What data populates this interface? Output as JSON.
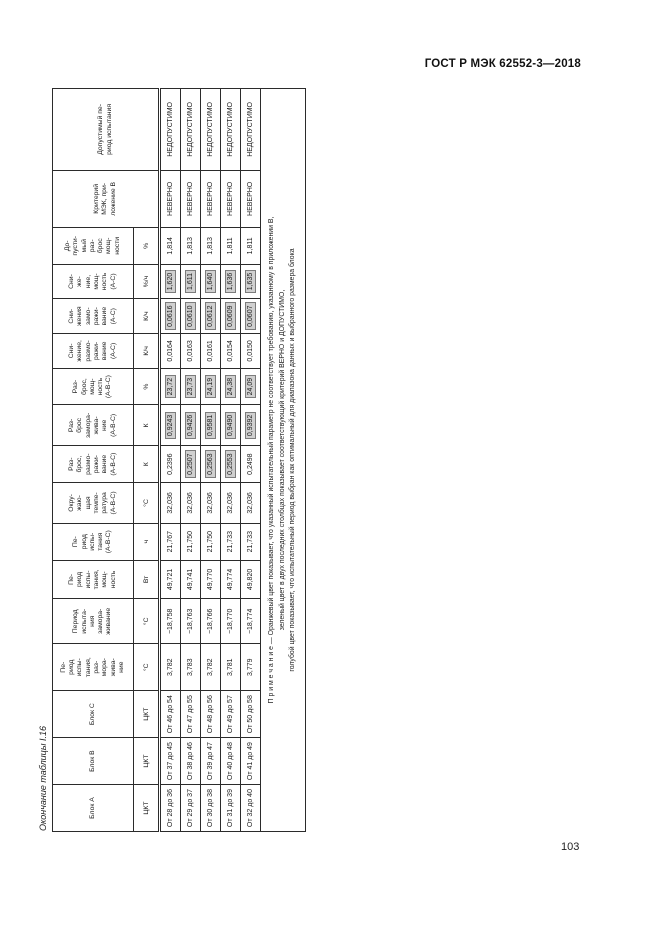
{
  "page": {
    "doc_header": "ГОСТ Р МЭК 62552-3—2018",
    "page_number": "103",
    "table_title": "Окончание таблицы I.16"
  },
  "colors": {
    "highlight_bg": "#d0d0d0",
    "highlight_border": "#7c7c7c",
    "text": "#1d1d1d"
  },
  "table": {
    "columns": [
      {
        "label": "Блок А",
        "unit": "ЦКТ"
      },
      {
        "label": "Блок В",
        "unit": "ЦКТ"
      },
      {
        "label": "Блок С",
        "unit": "ЦКТ"
      },
      {
        "label": "Пе-\nриод\nиспы-\nтания,\nраз-\nмора-\nжива-\nние",
        "unit": "°С"
      },
      {
        "label": "Период\nиспыта-\nния\nзамора-\nживание",
        "unit": "°С"
      },
      {
        "label": "Пе-\nриод\nиспы-\nтания,\nмощ-\nность",
        "unit": "Вт"
      },
      {
        "label": "Пе-\nриод\nиспы-\nтания\n(А-В-С)",
        "unit": "ч"
      },
      {
        "label": "Окру-\nжаю-\nщая\nтемпе-\nратура\n(А-В-С)",
        "unit": "°С"
      },
      {
        "label": "Раз-\nброс,\nразмо-\nражи-\nвание\n(А-В-С)",
        "unit": "К"
      },
      {
        "label": "Раз-\nброс\nзамора-\nжива-\nние\n(А-В-С)",
        "unit": "К"
      },
      {
        "label": "Раз-\nброс,\nмощ-\nность\n(А-В-С)",
        "unit": "%"
      },
      {
        "label": "Сни-\nжение,\nразмо-\nражи-\nвание\n(А-С)",
        "unit": "К/ч"
      },
      {
        "label": "Сни-\nжения\nзамо-\nражи-\nвание\n(А-С)",
        "unit": "К/ч"
      },
      {
        "label": "Сни-\nже-\nние,\nмощ-\nность\n(А-С)",
        "unit": "%/ч"
      },
      {
        "label": "До-\nпусти-\nмый\nраз-\nброс\nмощ-\nности",
        "unit": "%"
      },
      {
        "label": "Критерий\nМЭК, при-\nложение В",
        "unit": null
      },
      {
        "label": "Допустимый пе-\nриод испытания",
        "unit": null
      }
    ],
    "rows": [
      [
        {
          "t": "От 28 до 36",
          "h": false
        },
        {
          "t": "От 37 до 45",
          "h": false
        },
        {
          "t": "От 46 до 54",
          "h": false
        },
        {
          "t": "3,782",
          "h": false
        },
        {
          "t": "−18,758",
          "h": false
        },
        {
          "t": "49,721",
          "h": false
        },
        {
          "t": "21,767",
          "h": false
        },
        {
          "t": "32,036",
          "h": false
        },
        {
          "t": "0,2396",
          "h": false
        },
        {
          "t": "0,9243",
          "h": true
        },
        {
          "t": "23,72",
          "h": true
        },
        {
          "t": "0,0164",
          "h": false
        },
        {
          "t": "0,0616",
          "h": true
        },
        {
          "t": "1,620",
          "h": true
        },
        {
          "t": "1,814",
          "h": false
        },
        {
          "t": "НЕВЕРНО",
          "h": false
        },
        {
          "t": "НЕДОПУСТИМО",
          "h": false
        }
      ],
      [
        {
          "t": "От 29 до 37",
          "h": false
        },
        {
          "t": "От 38 до 46",
          "h": false
        },
        {
          "t": "От 47 до 55",
          "h": false
        },
        {
          "t": "3,783",
          "h": false
        },
        {
          "t": "−18,763",
          "h": false
        },
        {
          "t": "49,741",
          "h": false
        },
        {
          "t": "21,750",
          "h": false
        },
        {
          "t": "32,036",
          "h": false
        },
        {
          "t": "0,2507",
          "h": true
        },
        {
          "t": "0,9426",
          "h": true
        },
        {
          "t": "23,73",
          "h": true
        },
        {
          "t": "0,0163",
          "h": false
        },
        {
          "t": "0,0610",
          "h": true
        },
        {
          "t": "1,611",
          "h": true
        },
        {
          "t": "1,813",
          "h": false
        },
        {
          "t": "НЕВЕРНО",
          "h": false
        },
        {
          "t": "НЕДОПУСТИМО",
          "h": false
        }
      ],
      [
        {
          "t": "От 30 до 38",
          "h": false
        },
        {
          "t": "От 39 до 47",
          "h": false
        },
        {
          "t": "От 48 до 56",
          "h": false
        },
        {
          "t": "3,782",
          "h": false
        },
        {
          "t": "−18,766",
          "h": false
        },
        {
          "t": "49,770",
          "h": false
        },
        {
          "t": "21,750",
          "h": false
        },
        {
          "t": "32,036",
          "h": false
        },
        {
          "t": "0,2563",
          "h": true
        },
        {
          "t": "0,9581",
          "h": true
        },
        {
          "t": "24,19",
          "h": true
        },
        {
          "t": "0,0161",
          "h": false
        },
        {
          "t": "0,0612",
          "h": true
        },
        {
          "t": "1,640",
          "h": true
        },
        {
          "t": "1,813",
          "h": false
        },
        {
          "t": "НЕВЕРНО",
          "h": false
        },
        {
          "t": "НЕДОПУСТИМО",
          "h": false
        }
      ],
      [
        {
          "t": "От 31 до 39",
          "h": false
        },
        {
          "t": "От 40 до 48",
          "h": false
        },
        {
          "t": "От 49 до 57",
          "h": false
        },
        {
          "t": "3,781",
          "h": false
        },
        {
          "t": "−18,770",
          "h": false
        },
        {
          "t": "49,774",
          "h": false
        },
        {
          "t": "21,733",
          "h": false
        },
        {
          "t": "32,036",
          "h": false
        },
        {
          "t": "0,2553",
          "h": true
        },
        {
          "t": "0,9490",
          "h": true
        },
        {
          "t": "24,38",
          "h": true
        },
        {
          "t": "0,0154",
          "h": false
        },
        {
          "t": "0,0609",
          "h": true
        },
        {
          "t": "1,636",
          "h": true
        },
        {
          "t": "1,811",
          "h": false
        },
        {
          "t": "НЕВЕРНО",
          "h": false
        },
        {
          "t": "НЕДОПУСТИМО",
          "h": false
        }
      ],
      [
        {
          "t": "От 32 до 40",
          "h": false
        },
        {
          "t": "От 41 до 49",
          "h": false
        },
        {
          "t": "От 50 до 58",
          "h": false
        },
        {
          "t": "3,779",
          "h": false
        },
        {
          "t": "−18,774",
          "h": false
        },
        {
          "t": "49,820",
          "h": false
        },
        {
          "t": "21,733",
          "h": false
        },
        {
          "t": "32,036",
          "h": false
        },
        {
          "t": "0,2498",
          "h": false
        },
        {
          "t": "0,9392",
          "h": true
        },
        {
          "t": "24,09",
          "h": true
        },
        {
          "t": "0,0150",
          "h": false
        },
        {
          "t": "0,0607",
          "h": true
        },
        {
          "t": "1,635",
          "h": true
        },
        {
          "t": "1,811",
          "h": false
        },
        {
          "t": "НЕВЕРНО",
          "h": false
        },
        {
          "t": "НЕДОПУСТИМО",
          "h": false
        }
      ]
    ],
    "note_lines": [
      "П р и м е ч а н и е — Оранжевый цвет показывает, что указанный испытательный параметр не соответствует требованию, указанному в приложении В,",
      "зеленый цвет в двух последних столбцах показывает соответствующий критерий ВЕРНО и ДОПУСТИМО,",
      "голубой цвет показывает, что испытательный период выбран как оптимальный для диапазона данных и выбранного размера блока"
    ]
  }
}
